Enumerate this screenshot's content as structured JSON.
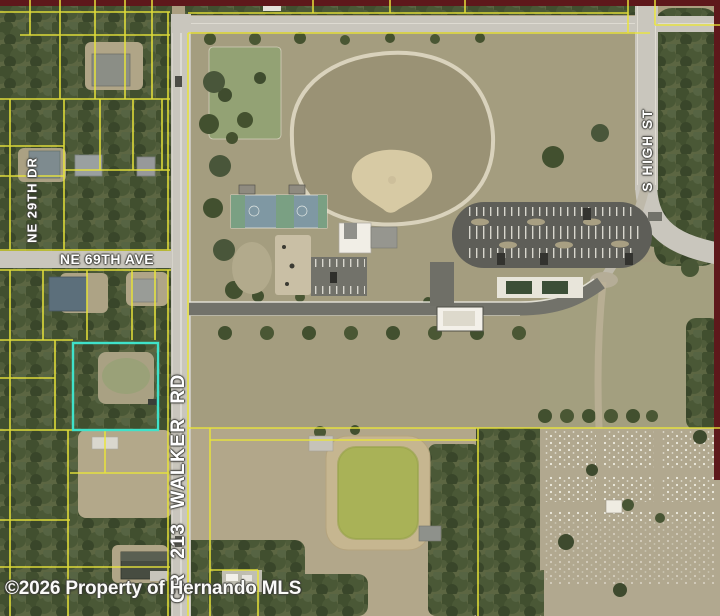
{
  "map_image": {
    "type": "aerial-parcel-map",
    "watermark": "©2026 Property of Hernando MLS",
    "streets": [
      {
        "id": "ne-29th-dr",
        "label": "NE 29TH DR",
        "orientation": "vertical"
      },
      {
        "id": "ne-69th-ave",
        "label": "NE 69TH AVE",
        "orientation": "horizontal"
      },
      {
        "id": "cr-213-walker-rd",
        "label": "CR 213 WALKER RD",
        "orientation": "vertical"
      },
      {
        "id": "s-high-st",
        "label": "S HIGH ST",
        "orientation": "vertical"
      }
    ],
    "colors": {
      "parcel_line": "#e9e53a",
      "selected_parcel": "#3fe2ca",
      "highway_overlay": "#5e181b",
      "road": "#c9c6bd",
      "asphalt": "#5e5e58",
      "park_ground": "#a49d7f",
      "tree_base": "#5c6642",
      "pond_water": "#a9b257",
      "label_text": "#ffffff"
    }
  }
}
